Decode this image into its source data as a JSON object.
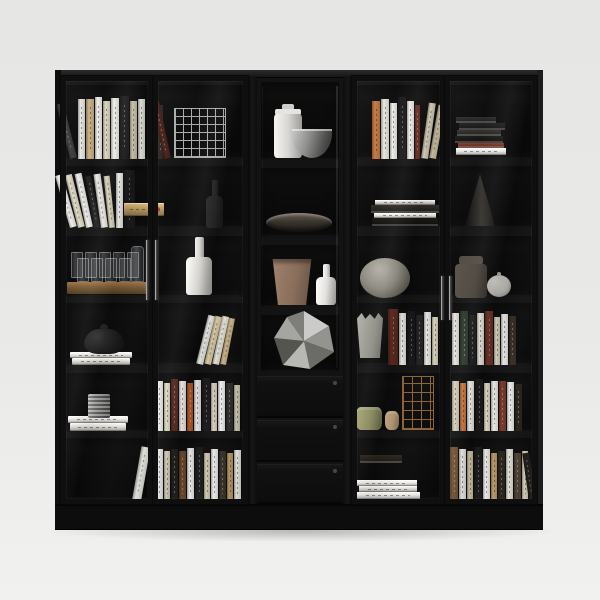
{
  "scene": {
    "palette": {
      "backdrop_top": "#e6e6e4",
      "backdrop_bottom": "#f1f1ef",
      "cabinet_body": "#131313",
      "cabinet_top_face": "#2c2c2c",
      "side_left": "#0e0e0e",
      "side_right": "#1d1d1d",
      "cell_dark": "#0a0a0a",
      "plinth": "#0d0d0d",
      "door_frame": "#0f0f0f",
      "handle_metal": "#9a9a9a"
    },
    "cabinet": {
      "x": 55,
      "y": 70,
      "w": 488,
      "h": 460,
      "top_face_h": 8,
      "side_w": 6
    },
    "plinth": {
      "x": 55,
      "y": 504,
      "w": 488,
      "h": 26
    },
    "shadow": {
      "x": 40,
      "y": 524,
      "w": 520,
      "h": 18
    },
    "cellGroups": [
      {
        "name": "left-door-left-column",
        "x": 66,
        "w": 83,
        "rows": [
          [
            85,
            74
          ],
          [
            166,
            62
          ],
          [
            236,
            61
          ],
          [
            303,
            62
          ],
          [
            373,
            59
          ],
          [
            438,
            63
          ]
        ]
      },
      {
        "name": "left-door-right-column",
        "x": 155,
        "w": 89,
        "rows": [
          [
            85,
            74
          ],
          [
            166,
            62
          ],
          [
            236,
            61
          ],
          [
            303,
            62
          ],
          [
            373,
            59
          ],
          [
            438,
            63
          ]
        ]
      },
      {
        "name": "middle-open-column",
        "x": 261,
        "w": 78,
        "rows": [
          [
            82,
            78
          ],
          [
            168,
            69
          ],
          [
            245,
            62
          ],
          [
            315,
            57
          ]
        ],
        "wall": true
      },
      {
        "name": "right-door-left-column",
        "x": 355,
        "w": 89,
        "rows": [
          [
            85,
            74
          ],
          [
            166,
            62
          ],
          [
            236,
            61
          ],
          [
            303,
            62
          ],
          [
            373,
            59
          ],
          [
            438,
            63
          ]
        ]
      },
      {
        "name": "right-door-right-column",
        "x": 450,
        "w": 86,
        "rows": [
          [
            85,
            74
          ],
          [
            166,
            62
          ],
          [
            236,
            61
          ],
          [
            303,
            62
          ],
          [
            373,
            59
          ],
          [
            438,
            63
          ]
        ]
      }
    ],
    "pillars": [
      {
        "x": 248,
        "y": 76,
        "w": 9,
        "h": 428
      },
      {
        "x": 343,
        "y": 76,
        "w": 9,
        "h": 428
      }
    ],
    "drawers": {
      "x": 257,
      "w": 86,
      "knobX": 333,
      "list": [
        {
          "y": 376,
          "h": 42
        },
        {
          "y": 420,
          "h": 42
        },
        {
          "y": 464,
          "h": 40
        }
      ]
    },
    "doors": [
      {
        "x": 61,
        "y": 76,
        "w": 92,
        "h": 428
      },
      {
        "x": 153,
        "y": 76,
        "w": 95,
        "h": 428
      },
      {
        "x": 352,
        "y": 76,
        "w": 93,
        "h": 428
      },
      {
        "x": 445,
        "y": 76,
        "w": 92,
        "h": 428
      }
    ],
    "handles": [
      {
        "x": 146,
        "y": 240,
        "h": 60
      },
      {
        "x": 155,
        "y": 240,
        "h": 60
      },
      {
        "x": 441,
        "y": 276,
        "h": 44
      },
      {
        "x": 449,
        "y": 276,
        "h": 44
      }
    ],
    "streaks": [
      {
        "x": 336,
        "y": 86,
        "w": 2,
        "h": 282,
        "o": 0.13
      },
      {
        "x": 262,
        "y": 86,
        "w": 1,
        "h": 200,
        "o": 0.05
      },
      {
        "x": 243,
        "y": 368,
        "w": 2,
        "h": 30,
        "o": 0.22
      }
    ],
    "items": [
      {
        "t": "books-v",
        "x": 70,
        "b": 159,
        "sp": [
          {
            "c": "#3c3c3c",
            "w": 7,
            "h": 56,
            "l": -14
          },
          {
            "c": "#e8e6e1",
            "w": 7,
            "h": 60
          },
          {
            "c": "#c9b188",
            "w": 8,
            "h": 60
          },
          {
            "c": "#f0efeb",
            "w": 7,
            "h": 62
          },
          {
            "c": "#ddd6c2",
            "w": 7,
            "h": 58
          },
          {
            "c": "#efeeea",
            "w": 8,
            "h": 61
          },
          {
            "c": "#1e1e1e",
            "w": 9,
            "h": 63
          },
          {
            "c": "#cfc7b0",
            "w": 7,
            "h": 58
          },
          {
            "c": "#e9e7e1",
            "w": 7,
            "h": 60
          }
        ]
      },
      {
        "t": "books-v",
        "x": 157,
        "b": 159,
        "sp": [
          {
            "c": "#2e2724",
            "w": 6,
            "h": 54
          },
          {
            "c": "#4a2018",
            "w": 7,
            "h": 58,
            "l": -12
          }
        ]
      },
      {
        "t": "cage",
        "x": 174,
        "y": 108,
        "w": 52,
        "h": 50,
        "c": "#c8c8c6",
        "cell": 8
      },
      {
        "t": "books-v",
        "x": 70,
        "b": 228,
        "sp": [
          {
            "c": "#efeeea",
            "w": 7,
            "h": 54,
            "l": -16
          },
          {
            "c": "#e2dcc9",
            "w": 7,
            "h": 54,
            "l": -14
          },
          {
            "c": "#f0efec",
            "w": 7,
            "h": 55,
            "l": -12
          },
          {
            "c": "#242424",
            "w": 6,
            "h": 52,
            "l": -10
          },
          {
            "c": "#eceae4",
            "w": 7,
            "h": 54,
            "l": -8
          },
          {
            "c": "#d9d2bd",
            "w": 6,
            "h": 52,
            "l": -6
          },
          {
            "c": "#f0efeb",
            "w": 7,
            "h": 55
          },
          {
            "c": "#1b1b1b",
            "w": 11,
            "h": 58
          }
        ]
      },
      {
        "t": "book-h",
        "x": 124,
        "y": 203,
        "w": 40,
        "h": 13,
        "c": "#b89a63",
        "dot": "#a23325"
      },
      {
        "t": "bottle",
        "x": 206,
        "y": 180,
        "w": 17,
        "h": 48,
        "nw": 6,
        "nh": 16,
        "c": "#242424"
      },
      {
        "t": "glass-tray",
        "x": 67,
        "y": 282,
        "w": 80,
        "h": 12,
        "c": "#7a5a36"
      },
      {
        "t": "bottle",
        "x": 186,
        "y": 237,
        "w": 26,
        "h": 58,
        "nw": 9,
        "nh": 20,
        "c": "#dcdbd6"
      },
      {
        "t": "book-h",
        "x": 70,
        "y": 352,
        "w": 62,
        "h": 6,
        "c": "#eceae5"
      },
      {
        "t": "book-h",
        "x": 72,
        "y": 358,
        "w": 58,
        "h": 7,
        "c": "#dfdcd4"
      },
      {
        "t": "teapot",
        "x": 84,
        "y": 324,
        "w": 40,
        "h": 30,
        "c": "#1a1a1a"
      },
      {
        "t": "books-v",
        "x": 196,
        "b": 365,
        "sp": [
          {
            "c": "#efeeea",
            "w": 7,
            "h": 50,
            "l": 14
          },
          {
            "c": "#decfa9",
            "w": 7,
            "h": 49,
            "l": 13
          },
          {
            "c": "#e8e4d8",
            "w": 7,
            "h": 49,
            "l": 12
          },
          {
            "c": "#c9b188",
            "w": 6,
            "h": 47,
            "l": 11
          }
        ]
      },
      {
        "t": "book-h",
        "x": 68,
        "y": 416,
        "w": 60,
        "h": 7,
        "c": "#eceae5"
      },
      {
        "t": "book-h",
        "x": 70,
        "y": 423,
        "w": 56,
        "h": 8,
        "c": "#e0ddd5"
      },
      {
        "t": "cup",
        "x": 88,
        "y": 394,
        "w": 22,
        "h": 24,
        "c": "#8e8e8c"
      },
      {
        "t": "books-v",
        "x": 156,
        "b": 431,
        "sp": [
          {
            "c": "#efeeea",
            "w": 7,
            "h": 50
          },
          {
            "c": "#e3ddc8",
            "w": 6,
            "h": 48
          },
          {
            "c": "#5a2a20",
            "w": 7,
            "h": 52
          },
          {
            "c": "#f0efec",
            "w": 7,
            "h": 50
          },
          {
            "c": "#b55a28",
            "w": 6,
            "h": 48
          },
          {
            "c": "#ececea",
            "w": 7,
            "h": 51
          },
          {
            "c": "#1c1c1c",
            "w": 8,
            "h": 53
          },
          {
            "c": "#d8d0bb",
            "w": 6,
            "h": 48
          },
          {
            "c": "#efefec",
            "w": 7,
            "h": 50
          },
          {
            "c": "#2e2e2e",
            "w": 7,
            "h": 48
          },
          {
            "c": "#c9c2ae",
            "w": 6,
            "h": 46
          }
        ]
      },
      {
        "t": "books-v",
        "x": 132,
        "b": 501,
        "sp": [
          {
            "c": "#e9e8e3",
            "w": 9,
            "h": 54,
            "l": 10
          }
        ]
      },
      {
        "t": "books-v",
        "x": 156,
        "b": 501,
        "sp": [
          {
            "c": "#ececea",
            "w": 7,
            "h": 52
          },
          {
            "c": "#d9d2bd",
            "w": 6,
            "h": 50
          },
          {
            "c": "#23221f",
            "w": 7,
            "h": 52
          },
          {
            "c": "#6e4a2e",
            "w": 7,
            "h": 50
          },
          {
            "c": "#f0efec",
            "w": 7,
            "h": 53
          },
          {
            "c": "#1c1c1c",
            "w": 8,
            "h": 54
          },
          {
            "c": "#cfc8b2",
            "w": 6,
            "h": 48
          },
          {
            "c": "#ededeb",
            "w": 7,
            "h": 52
          },
          {
            "c": "#3a332c",
            "w": 7,
            "h": 50
          },
          {
            "c": "#b89a63",
            "w": 6,
            "h": 48
          },
          {
            "c": "#e8e6e0",
            "w": 7,
            "h": 51
          }
        ]
      },
      {
        "t": "canister",
        "x": 274,
        "y": 104,
        "w": 28,
        "h": 54,
        "c": "#d8d7d3"
      },
      {
        "t": "bowl",
        "x": 292,
        "y": 129,
        "w": 40,
        "h": 29
      },
      {
        "t": "dish",
        "x": 266,
        "y": 213,
        "w": 66,
        "h": 19
      },
      {
        "t": "pot",
        "x": 270,
        "y": 259,
        "w": 44,
        "h": 46,
        "c": "#8a6f5c"
      },
      {
        "t": "bottle",
        "x": 316,
        "y": 264,
        "w": 20,
        "h": 41,
        "nw": 7,
        "nh": 13,
        "c": "#e2e1dd"
      },
      {
        "t": "poly",
        "x": 272,
        "y": 310,
        "w": 64,
        "h": 60
      },
      {
        "t": "books-v",
        "x": 372,
        "b": 159,
        "sp": [
          {
            "c": "#c87840",
            "w": 8,
            "h": 58
          },
          {
            "c": "#e9e7e1",
            "w": 8,
            "h": 60
          },
          {
            "c": "#efeeea",
            "w": 7,
            "h": 56
          },
          {
            "c": "#1d1d1d",
            "w": 8,
            "h": 62
          },
          {
            "c": "#f0efec",
            "w": 7,
            "h": 58
          },
          {
            "c": "#6e2f24",
            "w": 5,
            "h": 54
          },
          {
            "c": "#d9d2bd",
            "w": 7,
            "h": 56,
            "l": 8
          },
          {
            "c": "#cfc4a6",
            "w": 7,
            "h": 54,
            "l": 10
          }
        ]
      },
      {
        "t": "books-h",
        "x": 456,
        "b": 155,
        "st": [
          {
            "c": "#e9e7e2",
            "w": 50,
            "h": 7,
            "dx": 0
          },
          {
            "c": "#6e2f24",
            "w": 46,
            "h": 5,
            "dx": 2
          },
          {
            "c": "#15130f",
            "w": 48,
            "h": 7,
            "dx": -1
          },
          {
            "c": "#2a2723",
            "w": 44,
            "h": 6,
            "dx": 1
          },
          {
            "c": "#1a1a1a",
            "w": 46,
            "h": 7,
            "dx": 3
          },
          {
            "c": "#242424",
            "w": 40,
            "h": 6,
            "dx": 0
          }
        ]
      },
      {
        "t": "books-h",
        "x": 372,
        "b": 226,
        "st": [
          {
            "c": "#15130f",
            "w": 66,
            "h": 8,
            "dx": 0
          },
          {
            "c": "#e8e6e0",
            "w": 62,
            "h": 5,
            "dx": 2
          },
          {
            "c": "#26231f",
            "w": 68,
            "h": 8,
            "dx": -1
          },
          {
            "c": "#d8d5cf",
            "w": 60,
            "h": 5,
            "dx": 3
          }
        ]
      },
      {
        "t": "cone",
        "x": 465,
        "y": 174,
        "w": 30,
        "h": 52
      },
      {
        "t": "vase-round",
        "x": 360,
        "y": 258,
        "w": 50,
        "h": 40
      },
      {
        "t": "jar",
        "x": 455,
        "y": 256,
        "w": 32,
        "h": 42,
        "c": "#4a443c"
      },
      {
        "t": "mini-teapot",
        "x": 487,
        "y": 272,
        "w": 24,
        "h": 25,
        "c": "#b5b3ae"
      },
      {
        "t": "tulip",
        "x": 357,
        "y": 312,
        "w": 26,
        "h": 46
      },
      {
        "t": "books-v",
        "x": 388,
        "b": 365,
        "sp": [
          {
            "c": "#5e2a1e",
            "w": 10,
            "h": 56
          },
          {
            "c": "#efeeea",
            "w": 7,
            "h": 52
          },
          {
            "c": "#18181a",
            "w": 8,
            "h": 54
          },
          {
            "c": "#232325",
            "w": 7,
            "h": 50
          },
          {
            "c": "#e9e7e2",
            "w": 7,
            "h": 53
          },
          {
            "c": "#d9d2bd",
            "w": 6,
            "h": 48
          }
        ]
      },
      {
        "t": "books-v",
        "x": 452,
        "b": 365,
        "sp": [
          {
            "c": "#e9e7e2",
            "w": 7,
            "h": 52
          },
          {
            "c": "#2e3a2e",
            "w": 8,
            "h": 54
          },
          {
            "c": "#1c1c1c",
            "w": 7,
            "h": 50
          },
          {
            "c": "#e6e3db",
            "w": 7,
            "h": 52
          },
          {
            "c": "#6e3428",
            "w": 8,
            "h": 54
          },
          {
            "c": "#d9d2bd",
            "w": 6,
            "h": 48
          },
          {
            "c": "#ececea",
            "w": 7,
            "h": 51
          },
          {
            "c": "#3a2e24",
            "w": 7,
            "h": 49
          }
        ]
      },
      {
        "t": "box-cyl",
        "x": 356,
        "y": 407,
        "w": 26,
        "h": 23,
        "c": "#8f8f63"
      },
      {
        "t": "box-cyl",
        "x": 385,
        "y": 411,
        "w": 14,
        "h": 19,
        "c": "#b59a74"
      },
      {
        "t": "cage",
        "x": 402,
        "y": 376,
        "w": 32,
        "h": 54,
        "c": "#a5743c",
        "cell": 9
      },
      {
        "t": "books-v",
        "x": 452,
        "b": 431,
        "sp": [
          {
            "c": "#d9d2bd",
            "w": 7,
            "h": 50
          },
          {
            "c": "#c87840",
            "w": 6,
            "h": 48
          },
          {
            "c": "#efeeea",
            "w": 7,
            "h": 50
          },
          {
            "c": "#1c1c1c",
            "w": 8,
            "h": 52
          },
          {
            "c": "#e3ddc8",
            "w": 6,
            "h": 48
          },
          {
            "c": "#efeeea",
            "w": 7,
            "h": 50
          },
          {
            "c": "#7a3a2a",
            "w": 7,
            "h": 50
          },
          {
            "c": "#ececea",
            "w": 7,
            "h": 49
          },
          {
            "c": "#2a241e",
            "w": 7,
            "h": 47
          }
        ]
      },
      {
        "t": "book-h",
        "x": 360,
        "y": 455,
        "w": 42,
        "h": 8,
        "c": "#241f1a"
      },
      {
        "t": "books-h",
        "x": 356,
        "b": 499,
        "st": [
          {
            "c": "#e9e7e2",
            "w": 64,
            "h": 7,
            "dx": 0
          },
          {
            "c": "#dfdcd4",
            "w": 58,
            "h": 6,
            "dx": 3
          },
          {
            "c": "#efeeea",
            "w": 60,
            "h": 6,
            "dx": 1
          }
        ]
      },
      {
        "t": "books-v",
        "x": 450,
        "b": 501,
        "sp": [
          {
            "c": "#7a5a3a",
            "w": 8,
            "h": 54
          },
          {
            "c": "#ececea",
            "w": 7,
            "h": 52
          },
          {
            "c": "#cfc4a6",
            "w": 6,
            "h": 50
          },
          {
            "c": "#1c1c1c",
            "w": 8,
            "h": 54
          },
          {
            "c": "#efeeea",
            "w": 7,
            "h": 52
          },
          {
            "c": "#b89a63",
            "w": 6,
            "h": 48
          },
          {
            "c": "#2a241e",
            "w": 7,
            "h": 50
          },
          {
            "c": "#e6e3db",
            "w": 7,
            "h": 52
          },
          {
            "c": "#514437",
            "w": 7,
            "h": 48
          },
          {
            "c": "#d9d2bd",
            "w": 6,
            "h": 50
          },
          {
            "c": "#23201c",
            "w": 7,
            "h": 48,
            "l": -8
          }
        ]
      }
    ]
  }
}
